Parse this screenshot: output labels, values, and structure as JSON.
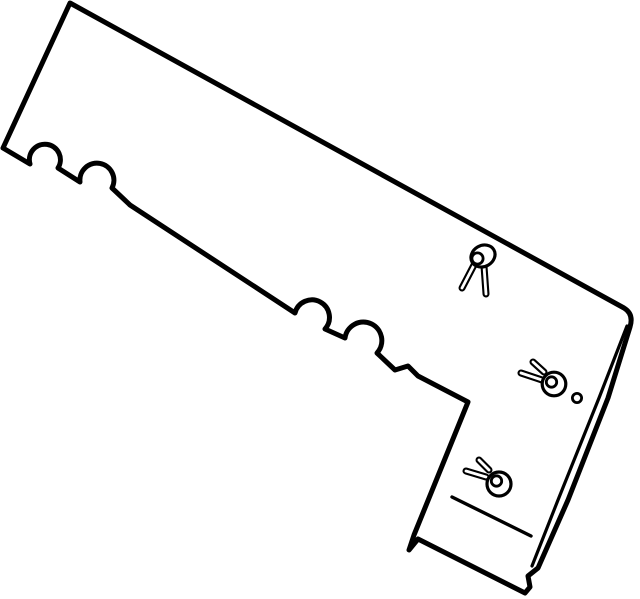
{
  "figure": {
    "kind": "parts-catalog-line-art",
    "subject": "angled L-shaped trim panel with scalloped notches, push-pin retainer clips, mounting hole, folded edge and crease line",
    "background_color": "#ffffff",
    "line_color": "#000000",
    "canvas": {
      "width": 640,
      "height": 599
    }
  },
  "geometry": {
    "viewbox": "0 0 640 599",
    "panel": {
      "name": "trim-panel-outline",
      "stroke_width": 5,
      "path": "M 70 3 L 624 308 Q 634 314 630 327 L 608 398 L 568 500 L 538 568 L 528 576 L 530 587 L 525 593 L 418 539 L 409 550 L 414 535 L 468 402 L 418 376 L 408 366 L 395 370 L 377 353 A 18.5 18.5 0 1 0 345 338 L 325 329 A 17.5 17.5 0 1 0 295 313 L 130 205 L 112 188 A 17 17 0 1 0 80 182 L 58 168 A 15.5 15.5 0 1 0 30 164 L 3 148 Z"
    },
    "fold_line": {
      "name": "right-edge-fold-line",
      "stroke_width": 3.2,
      "path": "M 627 326 L 599 398 L 558 500 L 532 566"
    },
    "crease_line": {
      "name": "bottom-flange-crease-line",
      "stroke_width": 3.4,
      "path": "M 452 497 L 531 536"
    },
    "hole": {
      "name": "mounting-hole",
      "cx": 577,
      "cy": 398,
      "r": 4.6,
      "stroke_width": 2.8
    },
    "clip_style": {
      "stem_outline_width": 7,
      "stem_core_width": 2.8,
      "head_stroke_width": 3.2,
      "pin_stroke_width": 2.8
    },
    "clips": [
      {
        "name": "push-pin-clip-top",
        "stems": [
          [
            474,
            265,
            462,
            288
          ],
          [
            484,
            266,
            486,
            294
          ]
        ],
        "head": {
          "cx": 483,
          "cy": 256,
          "rx": 12.5,
          "ry": 10.5,
          "rotate": -30
        },
        "pin": {
          "cx": 477.5,
          "cy": 258.5,
          "r": 5.6
        }
      },
      {
        "name": "push-pin-clip-middle",
        "stems": [
          [
            544,
            372,
            533,
            362
          ],
          [
            542,
            380,
            521,
            373
          ]
        ],
        "head": {
          "cx": 554,
          "cy": 384,
          "rx": 11.8,
          "ry": 11.8,
          "rotate": 0
        },
        "pin": {
          "cx": 551.5,
          "cy": 382,
          "r": 5.2
        }
      },
      {
        "name": "push-pin-clip-bottom",
        "stems": [
          [
            489,
            470,
            479,
            460
          ],
          [
            486,
            477,
            466,
            471
          ]
        ],
        "head": {
          "cx": 499,
          "cy": 484,
          "rx": 12,
          "ry": 12,
          "rotate": 0
        },
        "pin": {
          "cx": 496.5,
          "cy": 481,
          "r": 5.2
        }
      }
    ]
  }
}
